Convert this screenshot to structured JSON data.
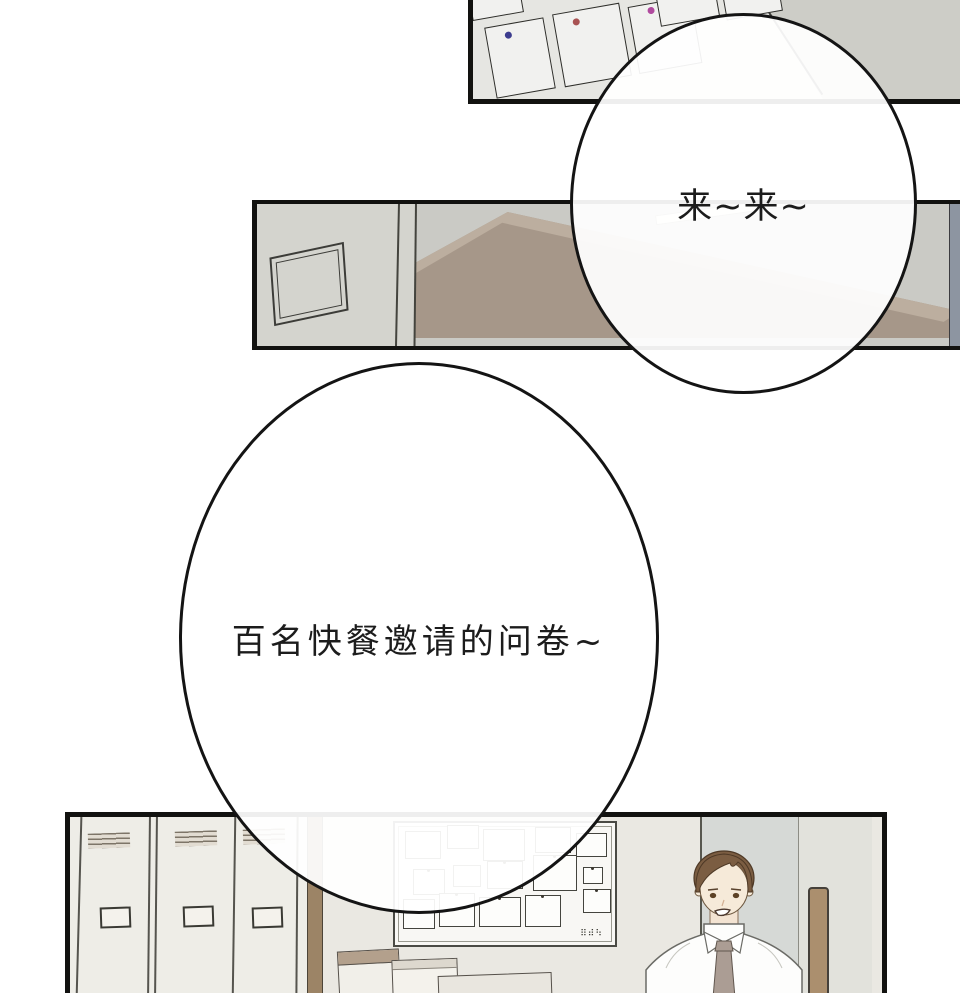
{
  "page": {
    "kind": "webtoon comic page",
    "background_color": "#ffffff",
    "panel_border_color": "#121210"
  },
  "bubbles": [
    {
      "text": "来~来~"
    },
    {
      "text": "百名快餐邀请的问卷~"
    }
  ],
  "panels": [
    {
      "name": "bulletin-board-closeup",
      "wall_color": "#e6e6e2",
      "pins": [
        "#3c3c8e",
        "#a85252",
        "#b04a9e"
      ]
    },
    {
      "name": "hallway-with-table",
      "wall_color": "#d4d4ce",
      "table_color": "#a69789",
      "side_wall_color": "#8d95a1"
    },
    {
      "name": "locker-room",
      "wall_color": "#eae8e2",
      "locker_color": "#eeede7",
      "pillar_color": "#9c8466",
      "board_scribble": "⠿⠾⠳",
      "character": {
        "description": "man-in-white-shirt-and-tie",
        "hair_color": "#7b5d42",
        "tie_color": "#ab9d94"
      }
    }
  ]
}
